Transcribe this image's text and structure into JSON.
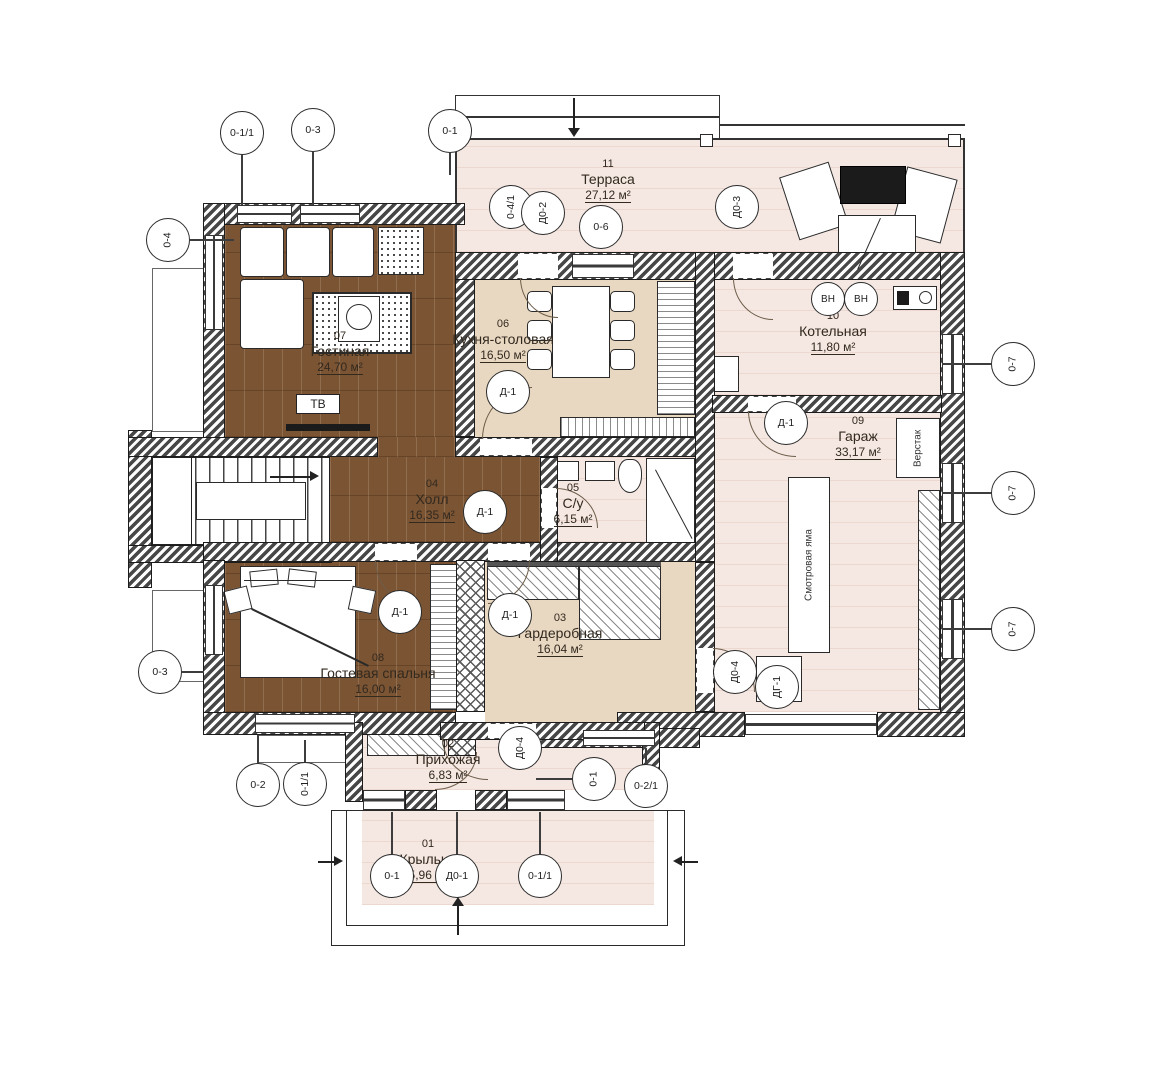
{
  "drawing": "floor-plan",
  "colors": {
    "floor_wood": "#7b5433",
    "floor_light": "#f5e8e2",
    "floor_beige": "#e9d8c1",
    "wall_line": "#1c1c1c"
  },
  "rooms": [
    {
      "num": "01",
      "name": "Крыльцо",
      "area": "5,96 м²"
    },
    {
      "num": "02",
      "name": "Прихожая",
      "area": "6,83 м²"
    },
    {
      "num": "03",
      "name": "Гардеробная",
      "area": "16,04 м²"
    },
    {
      "num": "04",
      "name": "Холл",
      "area": "16,35 м²"
    },
    {
      "num": "05",
      "name": "С/у",
      "area": "6,15 м²"
    },
    {
      "num": "06",
      "name": "Кухня-столовая",
      "area": "16,50 м²"
    },
    {
      "num": "07",
      "name": "Гостиная",
      "area": "24,70 м²"
    },
    {
      "num": "08",
      "name": "Гостевая спальня",
      "area": "16,00 м²"
    },
    {
      "num": "09",
      "name": "Гараж",
      "area": "33,17 м²"
    },
    {
      "num": "10",
      "name": "Котельная",
      "area": "11,80 м²"
    },
    {
      "num": "11",
      "name": "Терраса",
      "area": "27,12 м²"
    }
  ],
  "callouts": [
    {
      "label": "0-1/1"
    },
    {
      "label": "0-3"
    },
    {
      "label": "0-1"
    },
    {
      "label": "0-4"
    },
    {
      "label": "0-4/1"
    },
    {
      "label": "Д0-2"
    },
    {
      "label": "0-6"
    },
    {
      "label": "Д0-3"
    },
    {
      "label": "ВН"
    },
    {
      "label": "ВН"
    },
    {
      "label": "Д-1"
    },
    {
      "label": "Д-1"
    },
    {
      "label": "0-7"
    },
    {
      "label": "0-7"
    },
    {
      "label": "0-7"
    },
    {
      "label": "Д-1"
    },
    {
      "label": "Д-1"
    },
    {
      "label": "Д-1"
    },
    {
      "label": "Д0-4"
    },
    {
      "label": "ДГ-1"
    },
    {
      "label": "0-3"
    },
    {
      "label": "0-2"
    },
    {
      "label": "0-1/1"
    },
    {
      "label": "Д0-4"
    },
    {
      "label": "0-1"
    },
    {
      "label": "0-2/1"
    },
    {
      "label": "0-1"
    },
    {
      "label": "Д0-1"
    },
    {
      "label": "0-1/1"
    }
  ],
  "annotations": {
    "tv": "ТВ",
    "inspection_pit": "Смотровая яма",
    "workbench": "Верстак"
  }
}
